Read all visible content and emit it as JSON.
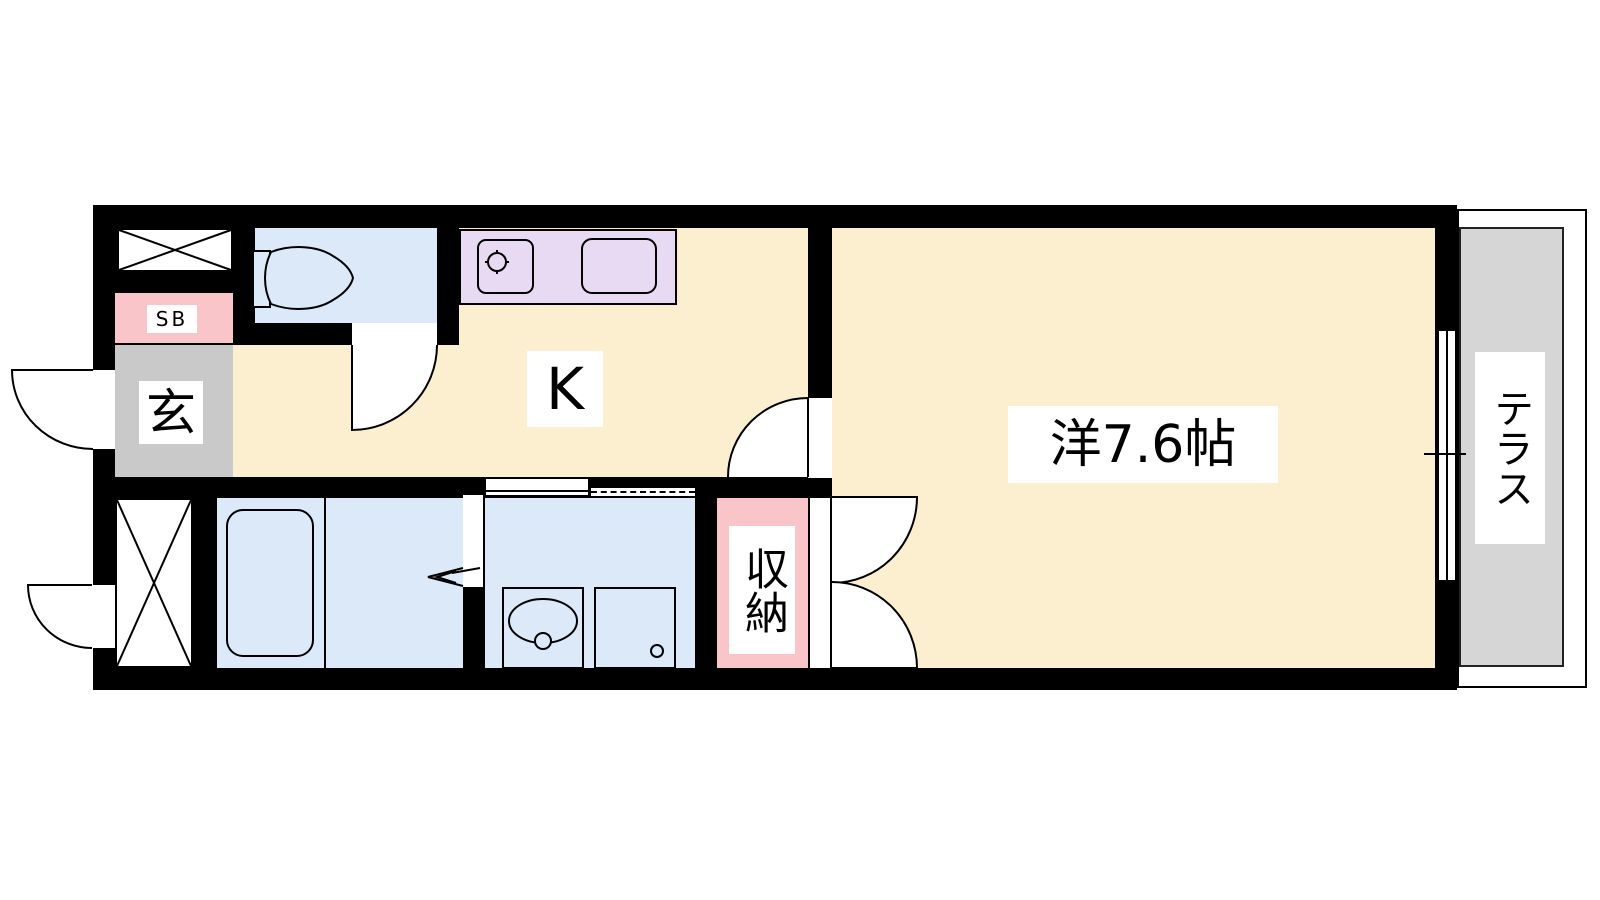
{
  "floorplan": {
    "title": "1K apartment floor plan",
    "labels": {
      "kitchen": "K",
      "western_room": "洋7.6帖",
      "entrance": "玄",
      "shoe_box": "SB",
      "closet": "収納",
      "terrace": "テラス"
    },
    "colors": {
      "floor": "#FBEFCF",
      "wet_area": "#DCE9F8",
      "kitchen_counter": "#E8DAF2",
      "accent_pink": "#F9C5C8",
      "entrance_gray": "#C9C9C9",
      "terrace_gray": "#D6D6D6",
      "wall": "#000000"
    }
  }
}
